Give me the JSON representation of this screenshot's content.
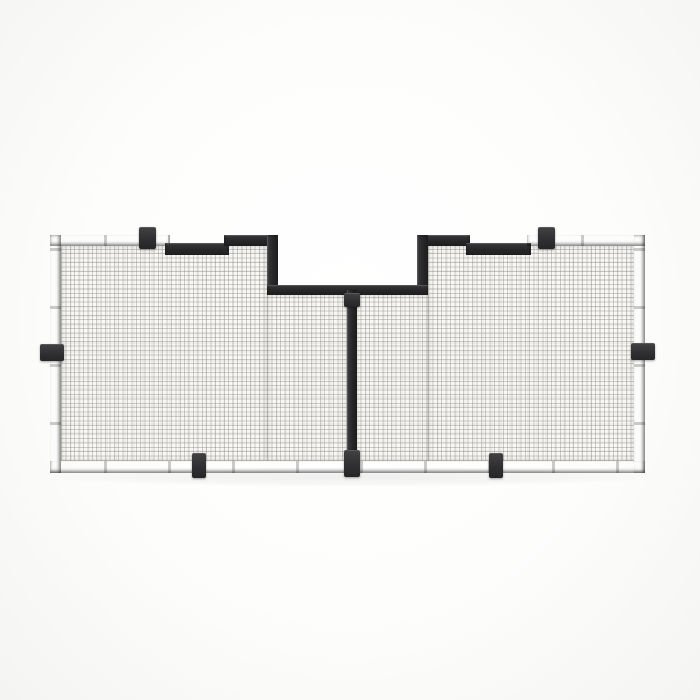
{
  "scene": {
    "description": "Studio product render of a black two-panel fine-mesh screen (vent / bug screen) with stepped notched top edge, center divider bar and six mounting clips, on a plain white background",
    "contains_text": false,
    "product": {
      "name": "two-panel-mesh-screen",
      "panels": 2,
      "mounting_clips": 6,
      "top_notches": 2,
      "center_cutout": "rectangular recess at top center between the two panels"
    }
  },
  "colors": {
    "bg": "#fcfcfb",
    "frame-hi": "#4a4a4c",
    "frame-face": "#303032",
    "frame-dark": "#262628",
    "frame-face2": "#353537",
    "tab-hi": "#424244",
    "mesh-bg": "#f8f8f6",
    "mesh-line": "rgba(150,145,138,0.45)"
  }
}
